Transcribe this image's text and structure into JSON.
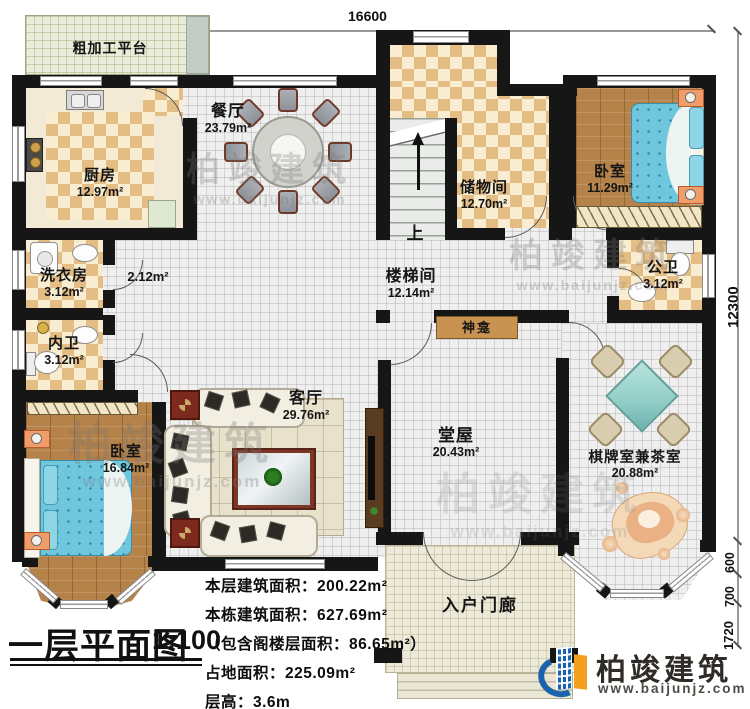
{
  "dimensions": {
    "top_width": "16600",
    "right_height": "12300",
    "seg_600": "600",
    "seg_700": "700",
    "seg_1720": "1720"
  },
  "rooms": {
    "platform": {
      "name": "粗加工平台"
    },
    "kitchen": {
      "name": "厨房",
      "area": "12.97m²"
    },
    "dining": {
      "name": "餐厅",
      "area": "23.79m²"
    },
    "storage": {
      "name": "储物间",
      "area": "12.70m²"
    },
    "bedroom_ne": {
      "name": "卧室",
      "area": "11.29m²"
    },
    "public_bath": {
      "name": "公卫",
      "area": "3.12m²"
    },
    "laundry": {
      "name": "洗衣房",
      "area": "3.12m²"
    },
    "inner_bath": {
      "name": "内卫",
      "area": "3.12m²"
    },
    "hallway": {
      "area": "2.12m²"
    },
    "stair_hall": {
      "name": "楼梯间",
      "area": "12.14m²"
    },
    "bedroom_sw": {
      "name": "卧室",
      "area": "16.84m²"
    },
    "living": {
      "name": "客厅",
      "area": "29.76m²"
    },
    "main_hall": {
      "name": "堂屋",
      "area": "20.43m²"
    },
    "chess_tea": {
      "name": "棋牌室兼茶室",
      "area": "20.88m²"
    },
    "porch": {
      "name": "入户门廊"
    },
    "shrine": {
      "name": "神龛"
    }
  },
  "stairs": {
    "up_label": "上"
  },
  "title_block": {
    "title": "一层平面图",
    "scale": "1:100",
    "info_lines": [
      "本层建筑面积：200.22m²",
      "本栋建筑面积：627.69m²",
      "（包含阁楼层面积：86.65m²）",
      "占地面积：225.09m²",
      "层高：3.6m"
    ]
  },
  "branding": {
    "company": "柏竣建筑",
    "website": "www.baijunjz.com"
  },
  "watermark": {
    "text": "柏竣建筑",
    "website": "www.baijunjz.com"
  },
  "colors": {
    "wall": "#161616",
    "checker_tan": "#e4bd85",
    "wood": "#b5824a",
    "bed_blue": "#6fc7de",
    "platform_green": "#e9edd9",
    "logo_blue": "#1b63ad",
    "logo_orange": "#f59f1e",
    "chess_table_teal": "#93cfc9"
  }
}
